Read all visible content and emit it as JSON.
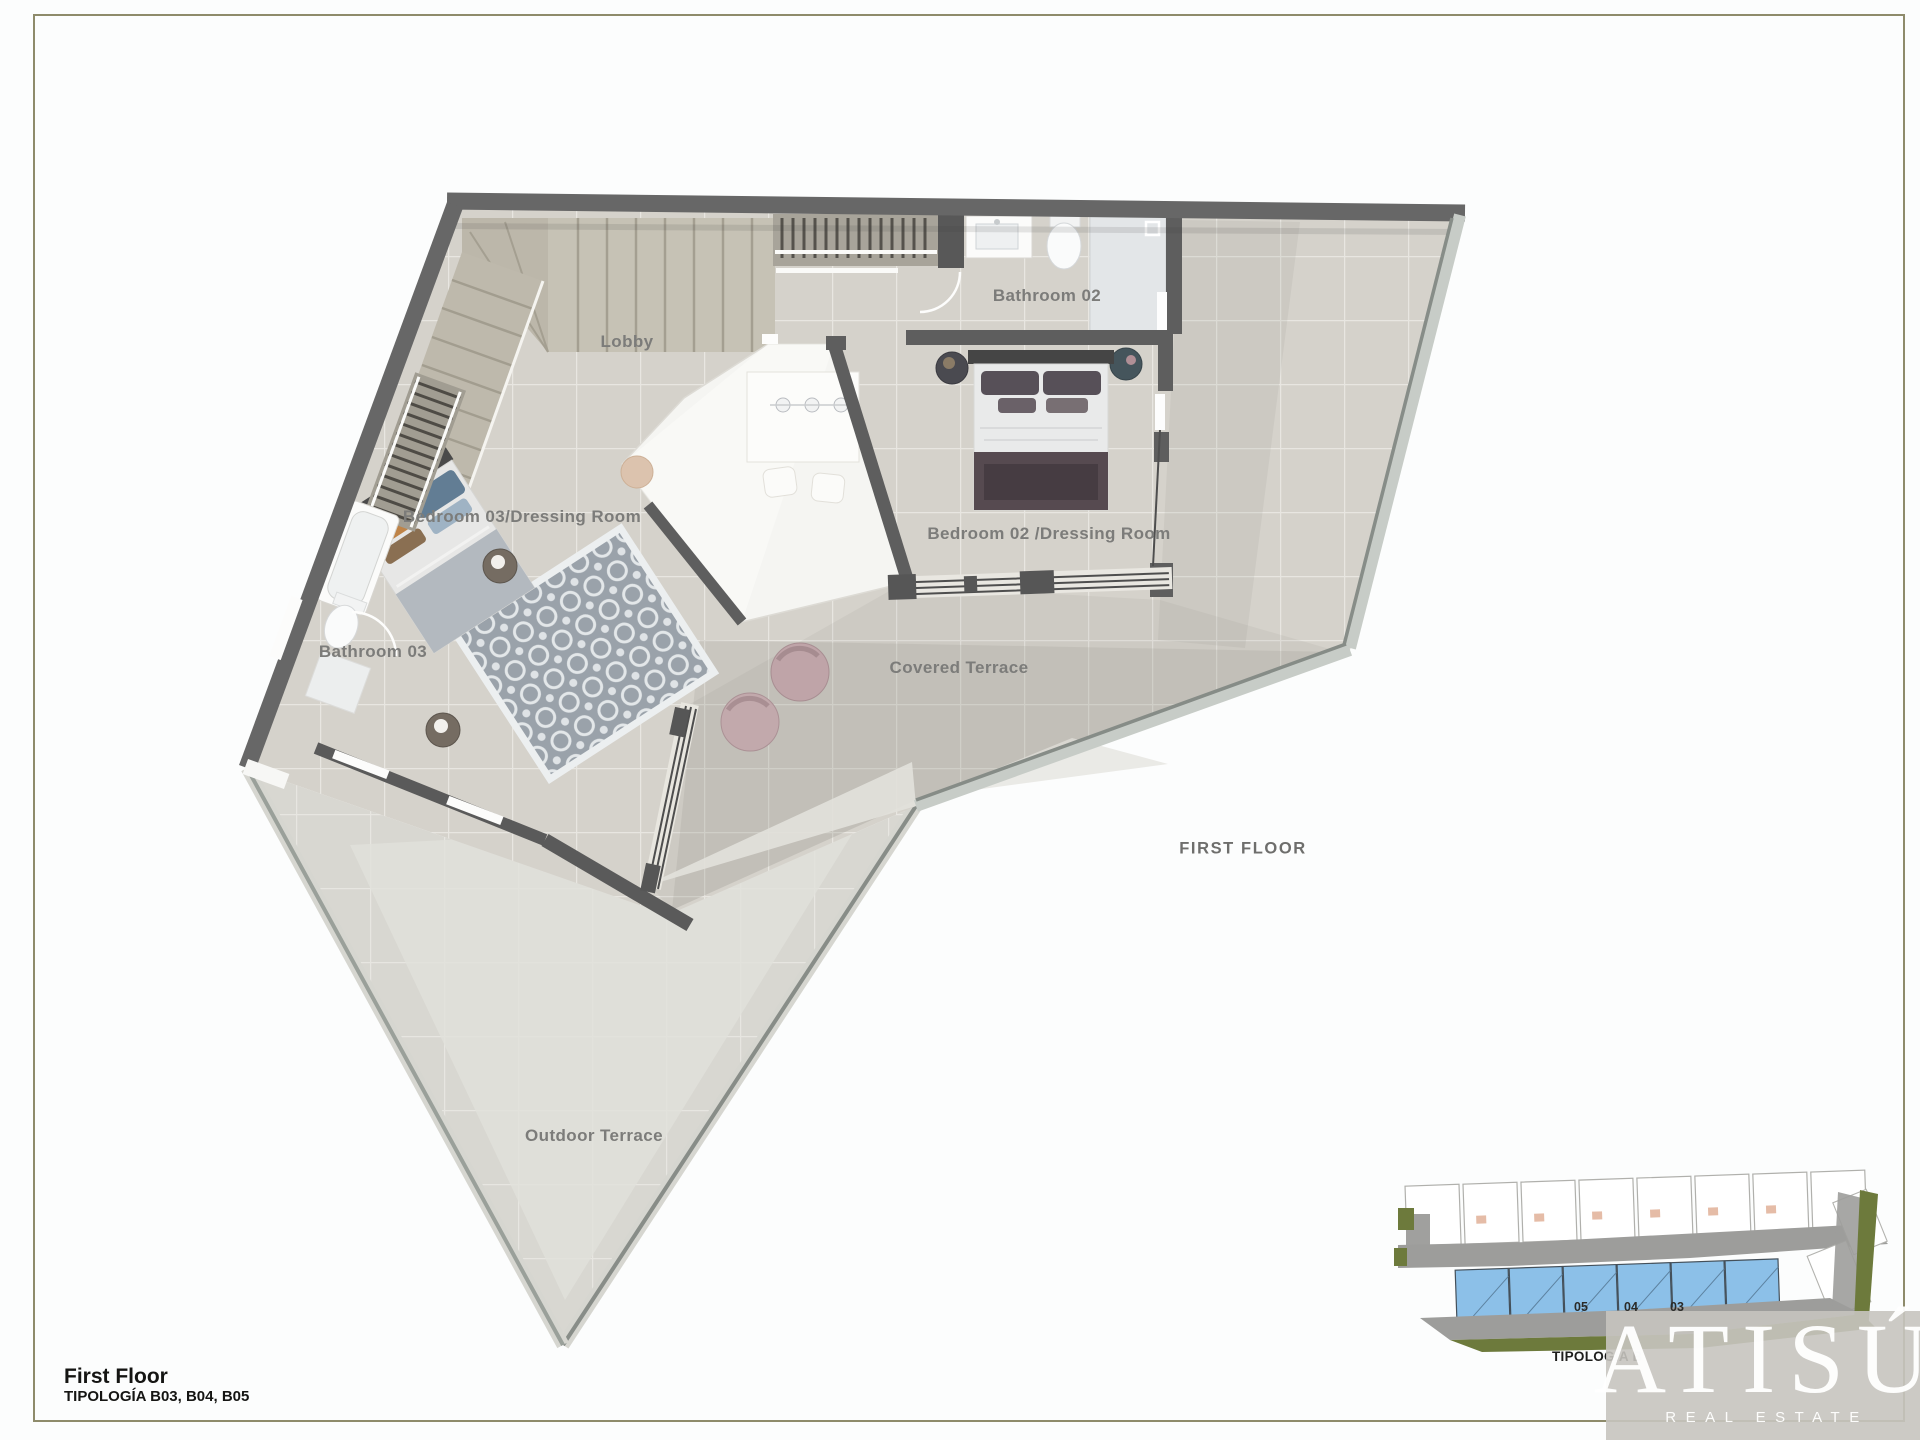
{
  "page": {
    "background": "#fcfdfd",
    "border_color": "#8e8b6b"
  },
  "floor_plan": {
    "labels": [
      {
        "id": "lobby",
        "text": "Lobby"
      },
      {
        "id": "bathroom-02",
        "text": "Bathroom 02"
      },
      {
        "id": "bedroom-03",
        "text": "Bedroom 03/Dressing Room"
      },
      {
        "id": "bathroom-03",
        "text": "Bathroom 03"
      },
      {
        "id": "bedroom-02",
        "text": "Bedroom 02 /Dressing Room"
      },
      {
        "id": "covered-terrace",
        "text": "Covered Terrace"
      },
      {
        "id": "outdoor-terrace",
        "text": "Outdoor Terrace"
      }
    ],
    "annotation": {
      "text": "FIRST FLOOR"
    },
    "colors": {
      "wall": "#676767",
      "interior_tile": "#d5d2cb",
      "terrace_tile": "#c9c7c1",
      "outdoor_tile": "#d8d7d1",
      "void_white": "#f5f5f2",
      "label_gray": "#7c7c7a"
    }
  },
  "title_block": {
    "title": "First Floor",
    "subtitle": "TIPOLOGÍA B03, B04, B05"
  },
  "site_plan": {
    "caption": "TIPOLOGÍA B",
    "unit_numbers": [
      "05",
      "04",
      "03"
    ],
    "highlight_color": "#8cc0e8",
    "road_color": "#9d9d9b",
    "green_color": "#6d7a3c"
  },
  "logo": {
    "brand": "ATISÚ",
    "tagline": "REAL ESTATE"
  }
}
